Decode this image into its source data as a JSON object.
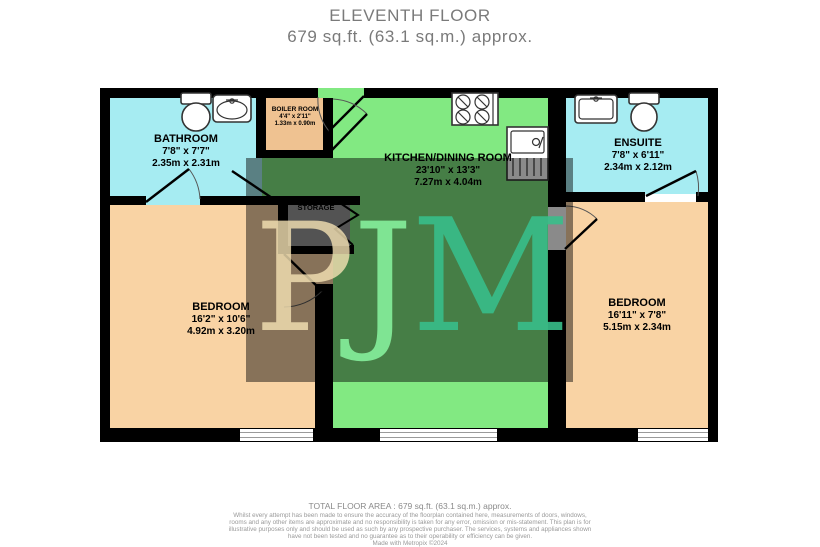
{
  "title": {
    "floor": "ELEVENTH FLOOR",
    "area": "679 sq.ft. (63.1 sq.m.) approx."
  },
  "rooms": {
    "bathroom": {
      "name": "BATHROOM",
      "imperial": "7'8\" x 7'7\"",
      "metric": "2.35m x 2.31m"
    },
    "boiler": {
      "name": "BOILER ROOM",
      "imperial": "4'4\" x 2'11\"",
      "metric": "1.33m x 0.90m"
    },
    "kitchen": {
      "name": "KITCHEN/DINING ROOM",
      "imperial": "23'10\" x 13'3\"",
      "metric": "7.27m x 4.04m"
    },
    "ensuite": {
      "name": "ENSUITE",
      "imperial": "7'8\" x 6'11\"",
      "metric": "2.34m x 2.12m"
    },
    "bedroom_left": {
      "name": "BEDROOM",
      "imperial": "16'2\" x 10'6\"",
      "metric": "4.92m x 3.20m"
    },
    "bedroom_right": {
      "name": "BEDROOM",
      "imperial": "16'11\" x 7'8\"",
      "metric": "5.15m x 2.34m"
    },
    "storage": {
      "name": "STORAGE"
    }
  },
  "watermark": {
    "p": "P",
    "j": "J",
    "m": "M"
  },
  "footer": {
    "total": "TOTAL FLOOR AREA : 679 sq.ft. (63.1 sq.m.) approx.",
    "disclaimer": "Whilst every attempt has been made to ensure the accuracy of the floorplan contained here, measurements of doors, windows, rooms and any other items are approximate and no responsibility is taken for any error, omission or mis-statement. This plan is for illustrative purposes only and should be used as such by any prospective purchaser. The services, systems and appliances shown have not been tested and no guarantee as to their operability or efficiency can be given.",
    "credit": "Made with Metropix ©2024"
  },
  "colors": {
    "bathroom": "#A6ECF2",
    "ensuite": "#A6ECF2",
    "bedroom": "#F9D3A4",
    "boiler": "#EFC291",
    "kitchen": "#82E982",
    "storage": "#9A9A9A",
    "wall": "#000000",
    "title_text": "#7A7A7A"
  }
}
